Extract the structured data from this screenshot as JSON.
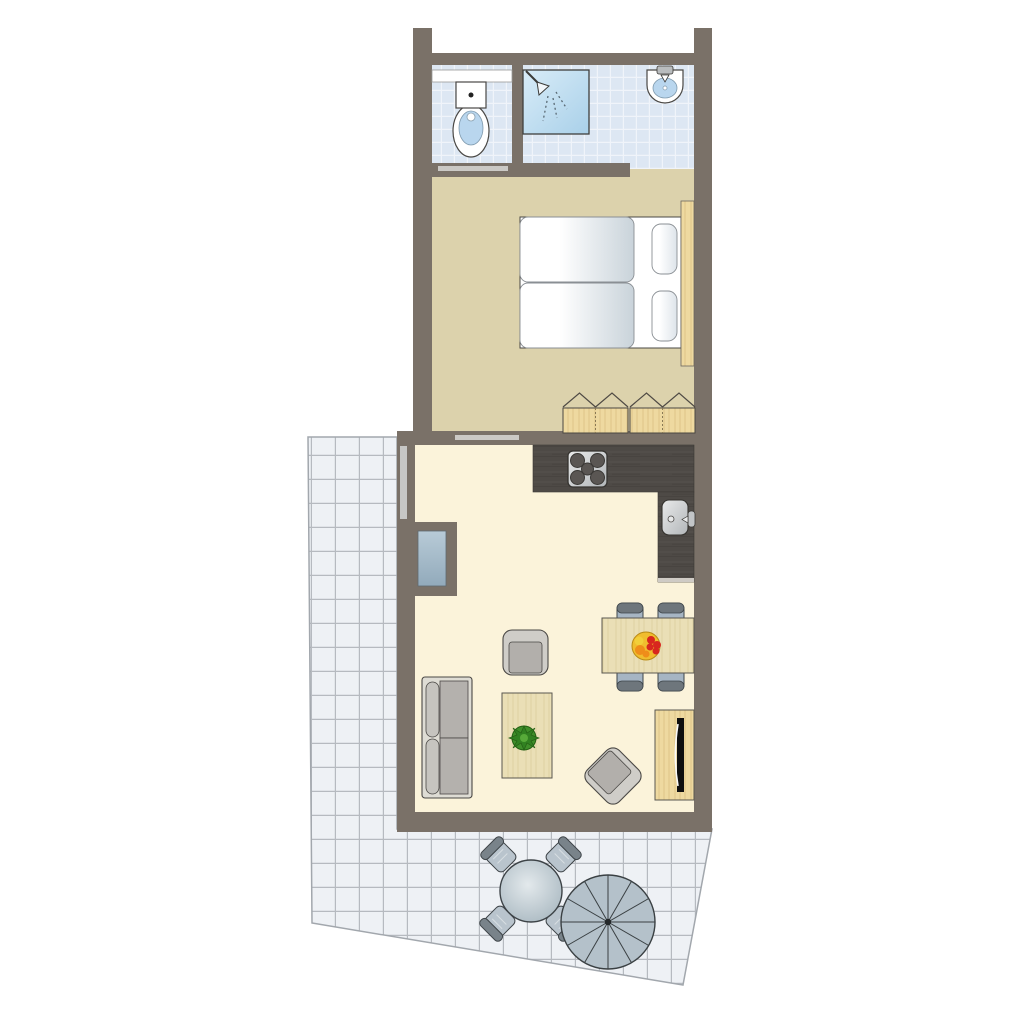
{
  "plan": {
    "title": "apartment floor plan",
    "view": "top-down",
    "rooms": {
      "bathroom": {
        "name": "bathroom",
        "fixtures": [
          "shelf",
          "toilet",
          "shower",
          "washbasin"
        ]
      },
      "bedroom": {
        "name": "bedroom",
        "furniture": [
          "double-bed",
          "pillows",
          "headboard",
          "wardrobe"
        ]
      },
      "living_kitchen": {
        "name": "living room / kitchen",
        "furniture": [
          "kitchen-counter",
          "stove",
          "kitchen-sink",
          "sofa",
          "armchair",
          "rotated-armchair",
          "coffee-table",
          "plant",
          "dining-table",
          "dining-chairs",
          "fruit-bowl",
          "tv-cabinet",
          "tv"
        ]
      },
      "terrace": {
        "name": "terrace",
        "furniture": [
          "outdoor-table",
          "outdoor-chairs",
          "parasol"
        ]
      }
    }
  },
  "colors": {
    "background": "#ffffff",
    "wall": "#7a7168",
    "outline": "#4a4845",
    "bathroom_tile": "#dde7f3",
    "bathroom_tile_line": "#ffffff",
    "shower_light": "#d8ecf8",
    "shower_dark": "#a9d0e9",
    "fixture_white": "#ffffff",
    "basin_blue": "#b9d6ee",
    "bedroom_floor": "#dcd2ac",
    "living_floor": "#fbf3da",
    "terrace_tile": "#eef1f5",
    "terrace_line": "#b6bac0",
    "terrace_edge": "#a2a7ad",
    "door_bar": "#cbc9c5",
    "window_bar": "#c7c7c5",
    "glass_light": "#b8cbd7",
    "glass_dark": "#92aabb",
    "wood_light": "#eed9a0",
    "wood_grain": "#d9bd7e",
    "wood_pale": "#eadfb6",
    "wood_pale_grain": "#d8cb96",
    "counter_dark": "#4e4a46",
    "counter_grain_light": "#5d5852",
    "counter_grain_dark": "#413d39",
    "counter_end": "#cfcbc5",
    "metal_light": "#e9eaea",
    "metal_dark": "#b2b6b9",
    "burner": "#5a5653",
    "mattress_light": "#ffffff",
    "mattress_dark": "#c9d3da",
    "pillow_dark": "#dde4ea",
    "sofa_frame": "#dedcd4",
    "sofa_seat": "#b4b1ad",
    "sofa_back": "#c6c4bf",
    "armchair_frame": "#cfcdc8",
    "armchair_seat": "#b2afab",
    "dining_chair": "#a6b5c3",
    "dining_chair_back": "#6e767c",
    "outdoor_seat": "#b9c4cd",
    "outdoor_back": "#79838a",
    "outdoor_table_light": "#e3e9ec",
    "outdoor_table_dark": "#a4b4bd",
    "parasol": "#b4c1ca",
    "parasol_line": "#3a4043",
    "tv_black": "#0e0e0e",
    "plant_green": "#3f8f2a",
    "plant_dark": "#2e7d1f",
    "plant_light": "#57aa39",
    "bowl_yellow": "#f0bd2e",
    "bowl_rim": "#b98a14",
    "fruit_red": "#d8271e",
    "fruit_orange": "#ef8d1a",
    "fruit_yellow": "#f2cf3a"
  }
}
